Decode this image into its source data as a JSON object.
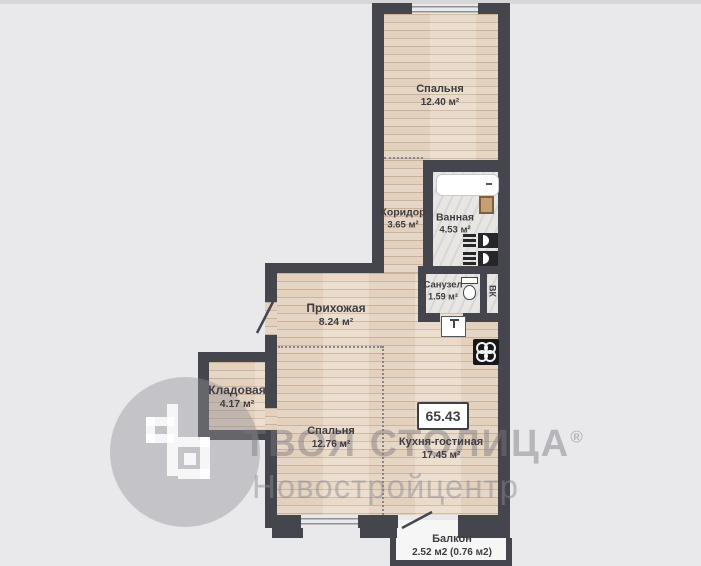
{
  "watermark": {
    "brand": "ТВОЯ СТОЛИЦА",
    "reg": "®",
    "sub": "Новостройцентр"
  },
  "total": {
    "value": "65.43"
  },
  "rooms": {
    "bedroom_top": {
      "name": "Спальня",
      "area": "12.40 м²"
    },
    "corridor": {
      "name": "Коридор",
      "area": "3.65 м²"
    },
    "bathroom": {
      "name": "Ванная",
      "area": "4.53 м²"
    },
    "wc": {
      "name": "Санузел",
      "area": "1.59 м²"
    },
    "hallway": {
      "name": "Прихожая",
      "area": "8.24 м²"
    },
    "storage": {
      "name": "Кладовая",
      "area": "4.17 м²"
    },
    "bedroom_bottom": {
      "name": "Спальня",
      "area": "12.76 м²"
    },
    "kitchen_living": {
      "name": "Кухня-гостиная",
      "area": "17.45 м²"
    },
    "balcony": {
      "name": "Балкон",
      "area": "2.52 м2 (0.76 м2)"
    }
  },
  "labels": {
    "shaft": "ВК"
  },
  "colors": {
    "wall": "#45454e",
    "wood": "#e7d6c4",
    "marble": "#e8e6e3",
    "background": "#e9e9ec",
    "label_text": "#3f3d42",
    "watermark_gray": "#9a9a9f"
  }
}
